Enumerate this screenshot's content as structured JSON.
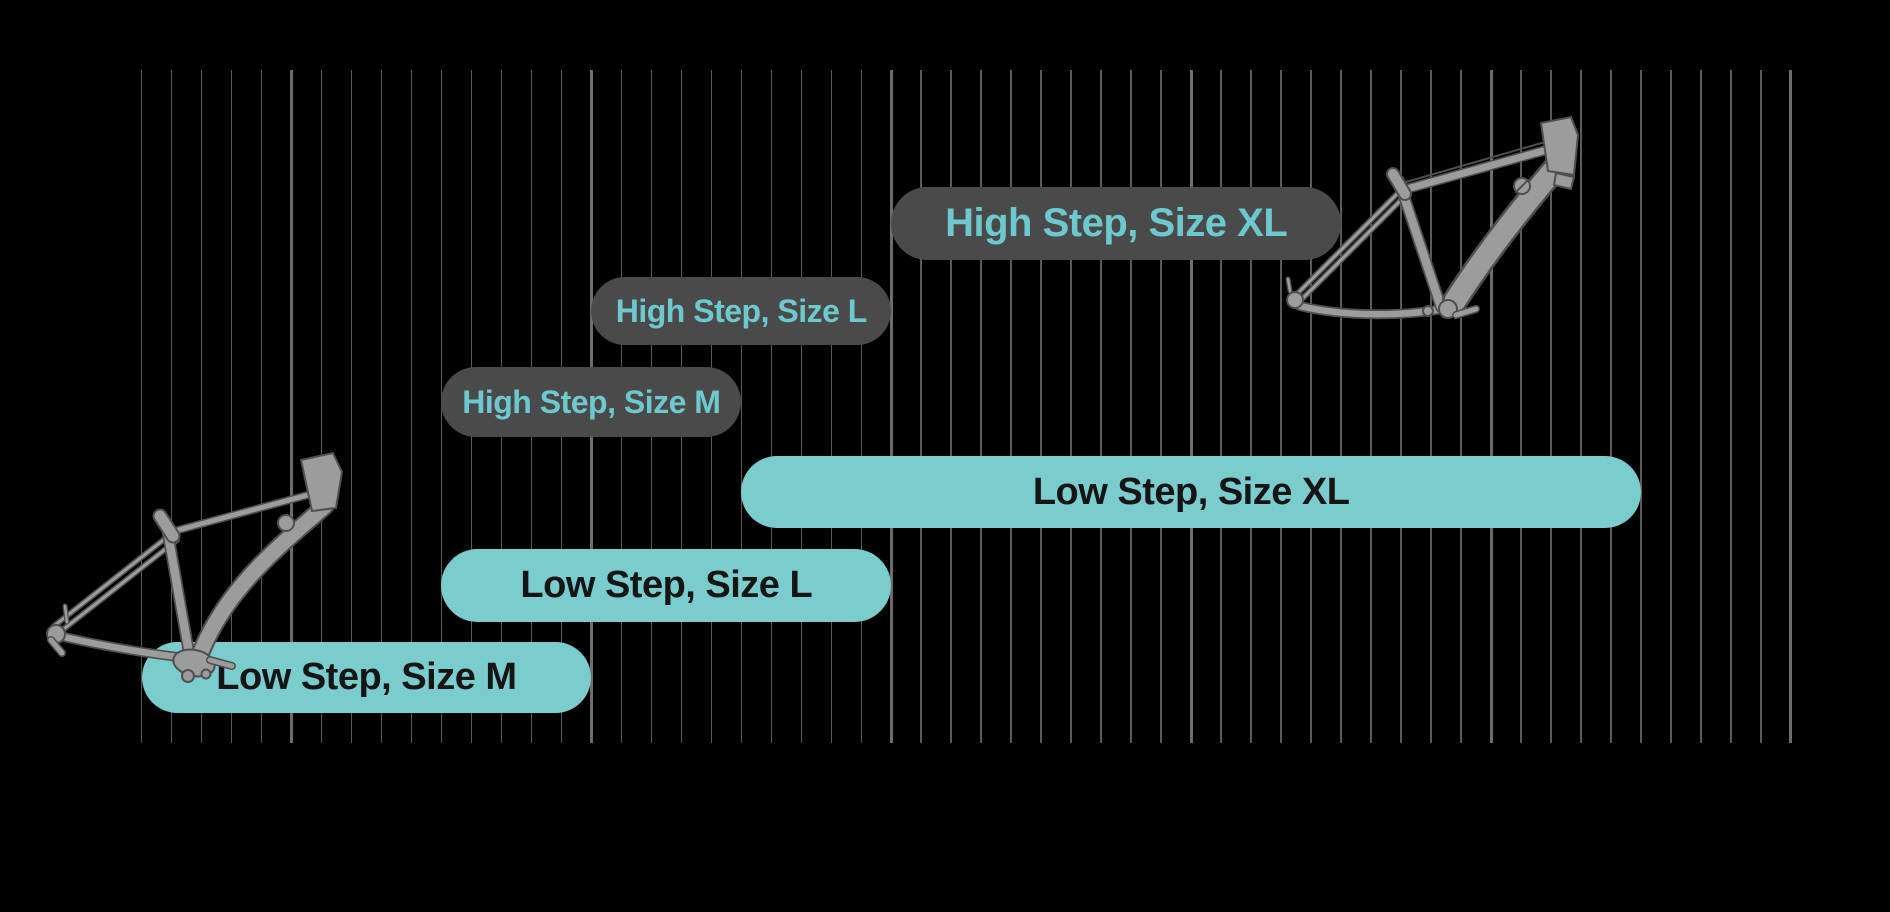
{
  "canvas": {
    "width": 1890,
    "height": 912,
    "background": "#000000"
  },
  "grid": {
    "x_start": 141.5,
    "spacing": 29.99,
    "line_count": 56,
    "y_top": 70,
    "y_bottom": 743,
    "major_every": 10,
    "major_offset": 5,
    "minor_color": "#5a5a5a",
    "major_color": "#6d6d6d",
    "minor_width": 1.5,
    "major_width": 3
  },
  "styles": {
    "dark_pill_bg": "#4a4a4b",
    "dark_pill_text": "#6ec9cf",
    "teal_pill_bg": "#7bcccd",
    "teal_pill_text": "#151515",
    "bike_fill": "#9c9c9c",
    "bike_outline": "#4f4f4f"
  },
  "chart_data": {
    "type": "bar",
    "orientation": "horizontal",
    "title": "",
    "note": "Bike frame size chart: horizontal range pills over a ruler of vertical gridlines (major line every 10 minor intervals). No axis tick labels are visible in the image; start/end are expressed in minor-gridline units from the leftmost gridline.",
    "categories": [
      "High Step, Size XL",
      "High Step, Size L",
      "High Step, Size M",
      "Low Step, Size XL",
      "Low Step, Size L",
      "Low Step, Size M"
    ],
    "series": [
      {
        "label": "High Step, Size XL",
        "variant": "dark",
        "start": 25,
        "end": 40,
        "y": 187,
        "h": 73,
        "font": 40
      },
      {
        "label": "High Step, Size L",
        "variant": "dark",
        "start": 15,
        "end": 25,
        "y": 277,
        "h": 68,
        "font": 32
      },
      {
        "label": "High Step, Size M",
        "variant": "dark",
        "start": 10,
        "end": 20,
        "y": 367,
        "h": 70,
        "font": 32
      },
      {
        "label": "Low Step, Size XL",
        "variant": "teal",
        "start": 20,
        "end": 50,
        "y": 456,
        "h": 72,
        "font": 38
      },
      {
        "label": "Low Step, Size L",
        "variant": "teal",
        "start": 10,
        "end": 25,
        "y": 549,
        "h": 73,
        "font": 38
      },
      {
        "label": "Low Step, Size M",
        "variant": "teal",
        "start": 0,
        "end": 15,
        "y": 642,
        "h": 71,
        "font": 38
      }
    ],
    "legend": "none",
    "grid_on": true
  },
  "illustrations": [
    {
      "name": "low-step-frame-illustration",
      "description": "gray line-art low-step e-bike frame, bottom left"
    },
    {
      "name": "high-step-frame-illustration",
      "description": "gray line-art high-step e-bike frame, top right"
    }
  ]
}
